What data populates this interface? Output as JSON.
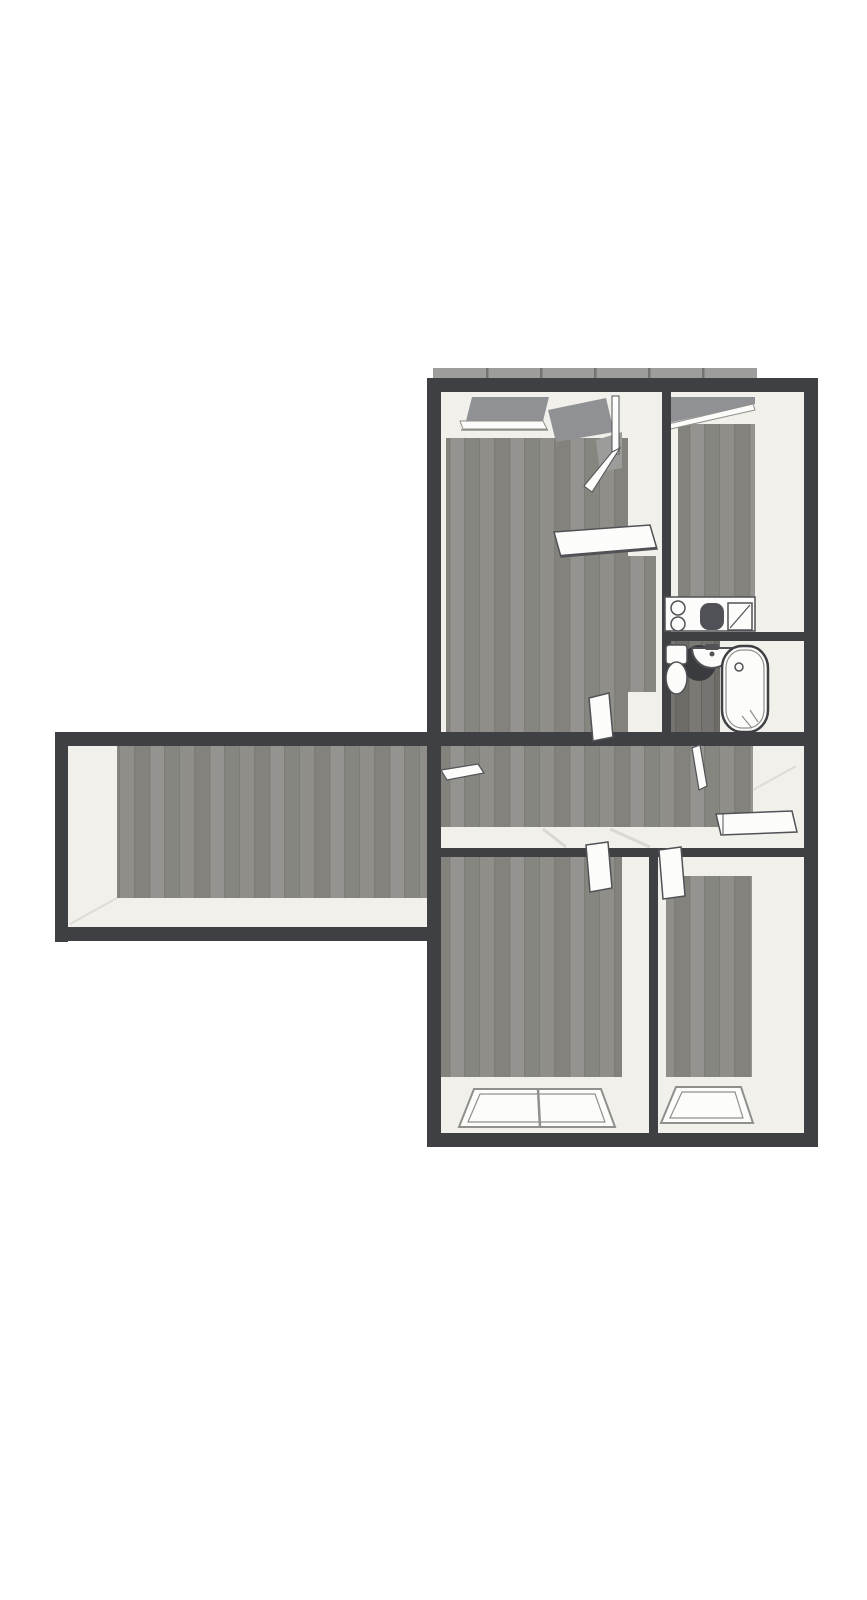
{
  "colors": {
    "background": "#ffffff",
    "wall": "#3f4043",
    "wall_face": "#f1f0eb",
    "wall_face_shadow": "#dddcd6",
    "white": "#fcfcfa",
    "outline": "#515256",
    "outline_soft": "#8f908b",
    "glass": "#8f9194",
    "glass_soft": "#9c9d9b",
    "glass_band": "#9d9d9c",
    "glass_tick": "#737372",
    "floor_planks": [
      "#8f8e89",
      "#83827d",
      "#949390",
      "#868681"
    ],
    "floor_seam": "#7d7c77",
    "floor_dark_planks": [
      "#757470",
      "#6d6c67",
      "#7a7973"
    ],
    "floor_dark_seam": "#64635f",
    "shadow_dark": "#3a3b3e",
    "fixture_dark": "#515257",
    "threshold": "#d9d8d2"
  },
  "plan": {
    "rooms": [
      {
        "id": "side-wing-room",
        "fixtures": []
      },
      {
        "id": "living-room",
        "fixtures": [
          "window",
          "balcony-glass-door",
          "wall-shelf",
          "open-door"
        ]
      },
      {
        "id": "kitchen",
        "fixtures": [
          "window",
          "countertop",
          "stove-burners",
          "sink",
          "drainboard"
        ]
      },
      {
        "id": "bathroom",
        "fixtures": [
          "toilet",
          "washbasin",
          "bathtub",
          "open-door"
        ]
      },
      {
        "id": "hallway",
        "fixtures": [
          "wall-shelf",
          "flat-open-door-panel"
        ]
      },
      {
        "id": "bedroom-left",
        "fixtures": [
          "double-window",
          "open-door"
        ]
      },
      {
        "id": "bedroom-right",
        "fixtures": [
          "window",
          "open-door"
        ]
      }
    ]
  }
}
